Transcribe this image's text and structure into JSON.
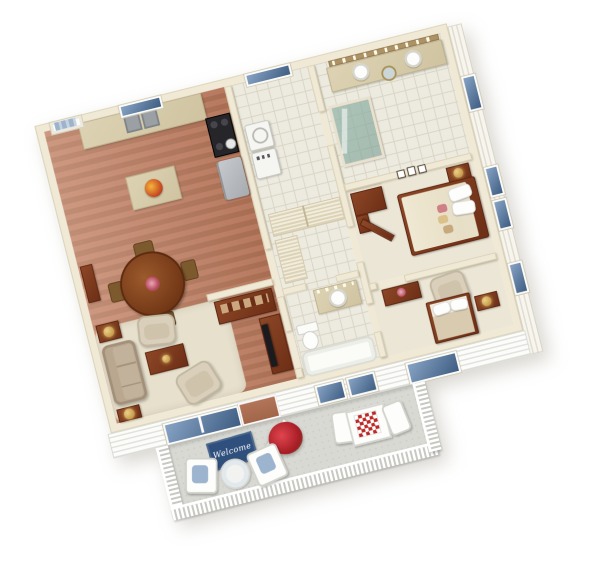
{
  "scene": {
    "description": "3D isometric cutaway floor plan of a two-bedroom, two-bath apartment with kitchen, dining area, living room, laundry room and furnished balcony, rendered on a white background",
    "welcome_mat_text": "Welcome",
    "rotation_deg": -14
  },
  "rooms": [
    {
      "id": "kitchen",
      "label": "Kitchen"
    },
    {
      "id": "dining",
      "label": "Dining Area"
    },
    {
      "id": "living",
      "label": "Living Room"
    },
    {
      "id": "laundry",
      "label": "Laundry / Utility Room"
    },
    {
      "id": "master-bath",
      "label": "Master Bathroom"
    },
    {
      "id": "hallway",
      "label": "Hallway with Closets"
    },
    {
      "id": "master-bedroom",
      "label": "Master Bedroom"
    },
    {
      "id": "bathroom2",
      "label": "Second Bathroom"
    },
    {
      "id": "bedroom2",
      "label": "Second Bedroom"
    },
    {
      "id": "balcony",
      "label": "Balcony"
    }
  ],
  "furniture": {
    "kitchen": [
      "front-door",
      "window",
      "upper-cabinets",
      "counter",
      "double-sink",
      "stove",
      "refrigerator",
      "island-with-fruit-bowl"
    ],
    "dining": [
      "round-table",
      "four-chairs",
      "flower-centerpiece",
      "sideboard",
      "china-cabinet"
    ],
    "living": [
      "area-rug",
      "sofa",
      "two-armchairs",
      "coffee-table",
      "two-end-tables-with-lamps",
      "tv-console-with-tv"
    ],
    "laundry": [
      "window",
      "washer",
      "dryer"
    ],
    "master_bath": [
      "double-vanity",
      "two-round-sinks",
      "round-mirror",
      "vanity-lights",
      "glass-shower",
      "window"
    ],
    "hallway": [
      "sliding-closets",
      "linen-closet",
      "wall-frames"
    ],
    "master_bedroom": [
      "double-bed",
      "pillows",
      "nightstand-with-lamp",
      "corner-dresser",
      "open-door",
      "two-windows",
      "wall-frames"
    ],
    "bathroom2": [
      "vanity-with-sink",
      "vanity-lights",
      "toilet",
      "bathtub"
    ],
    "bedroom2": [
      "bed",
      "pillows",
      "nightstand-with-lamp",
      "dresser-with-flowers",
      "armchair",
      "windows"
    ],
    "balcony": [
      "welcome-mat",
      "flower-pot",
      "two-cushioned-chairs",
      "round-side-table",
      "dining-table-with-checkered-cloth",
      "two-chairs",
      "white-railing"
    ]
  },
  "palette": {
    "wall": "#f0e9d6",
    "wall_edge": "#d8cfb4",
    "wood_floor": "#bb7c60",
    "tile_line": "#d9d5c5",
    "carpet": "#ece6d6",
    "counter_top": "#d5c9a6",
    "dark_wood": "#7b3a1e",
    "sofa_tan": "#b9a78f",
    "cream_chair": "#d9cfba",
    "balcony_floor": "#d8d9d3",
    "railing_white": "#ffffff",
    "window_glass": "#45618a",
    "mat": "#2f4f7d",
    "flower_red": "#c0262e",
    "lamp_gold": "#c79a3e",
    "stainless": "#babec2",
    "stove_black": "#26262a"
  }
}
